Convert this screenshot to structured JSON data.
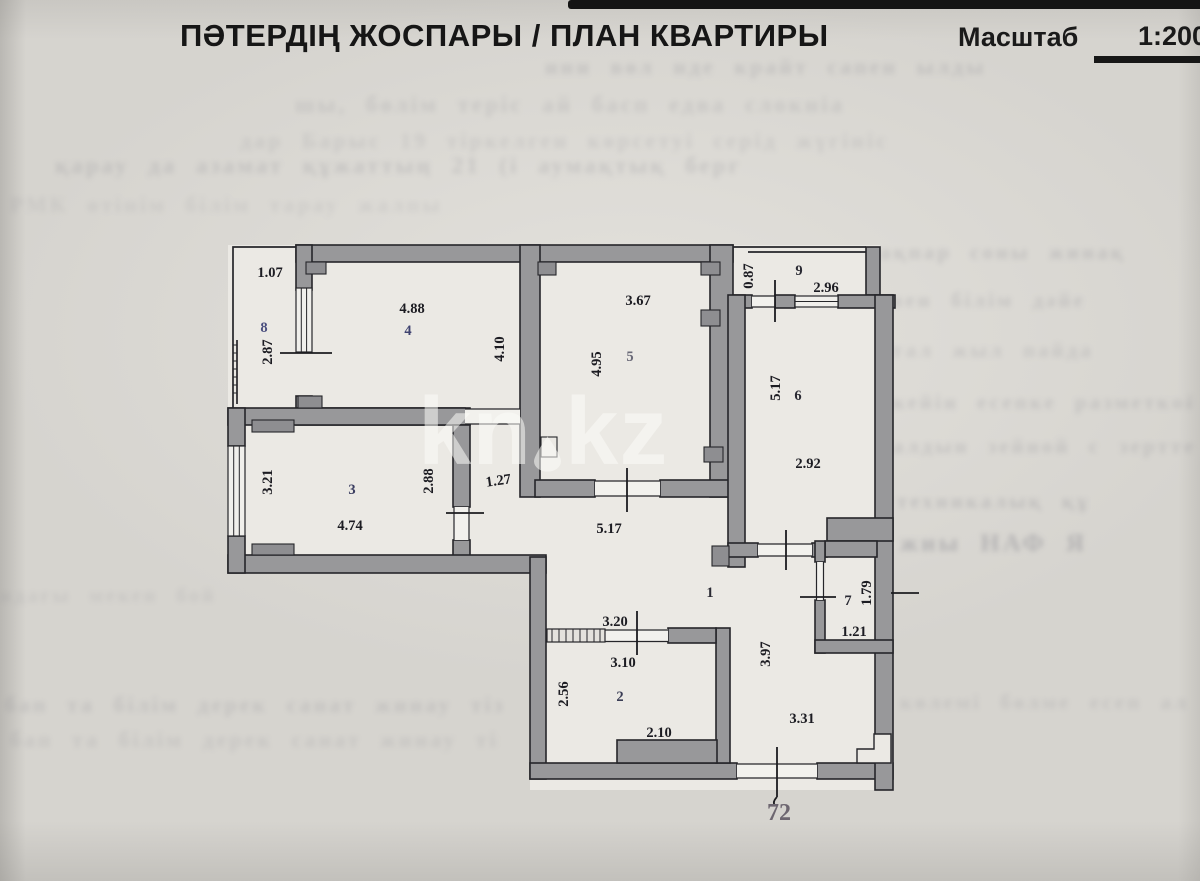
{
  "page": {
    "title": "ПӘТЕРДІҢ ЖОСПАРЫ / ПЛАН КВАРТИРЫ",
    "scale_label": "Масштаб",
    "scale_value": "1:200",
    "apartment_number": "72",
    "watermark_left": "kn",
    "watermark_right": "kz"
  },
  "plan": {
    "rooms": {
      "r1": "1",
      "r2": "2",
      "r3": "3",
      "r4": "4",
      "r5": "5",
      "r6": "6",
      "r7": "7",
      "r8": "8",
      "r9": "9"
    },
    "dims": {
      "balcony8_width": "1.07",
      "balcony8_length": "2.87",
      "room4_width": "4.88",
      "room4_depth": "4.10",
      "room5_width": "3.67",
      "room5_depth": "4.95",
      "balcony9_depth": "0.87",
      "balcony9_width": "2.96",
      "room6_depth": "5.17",
      "room6_width": "2.92",
      "room3_depth": "3.21",
      "room3_width": "4.74",
      "room3_right": "2.88",
      "corridor_width": "1.27",
      "hall_width": "5.17",
      "hall_depth": "3.97",
      "hall_entry": "3.31",
      "room2_opening": "3.20",
      "room2_width": "3.10",
      "room2_depth": "2.56",
      "room2_block": "2.10",
      "room7_depth": "1.79",
      "room7_width": "1.21"
    },
    "colors": {
      "wall": "#98989a",
      "interior": "#ebe9e4",
      "line": "#26262a",
      "paper": "#d6d4cf"
    }
  },
  "bleed": {
    "lines": [
      "ини вөл нде крайт сапен ылды",
      "шы, бөлім теріс ай басп едва слокніа",
      "дар Барыс 19 тіркелген көрсетуі серід жүгініс",
      "қарау да азамат құжаттың 21 (і аумақтық берг",
      "РМК өтінім білім тарау жалпы",
      "ақпар соны жинақ",
      "мен білім дәйе",
      "тал жыл пайда",
      "кейін есепке разметкой",
      "алдын зейной с зерттеу",
      "техникалық құ",
      "жиы НАФ Я",
      "ндағы мекен бойын",
      "бап та білім дерек санат жинау тіз",
      "көлемі бөлме есеп алаң жазба"
    ]
  }
}
